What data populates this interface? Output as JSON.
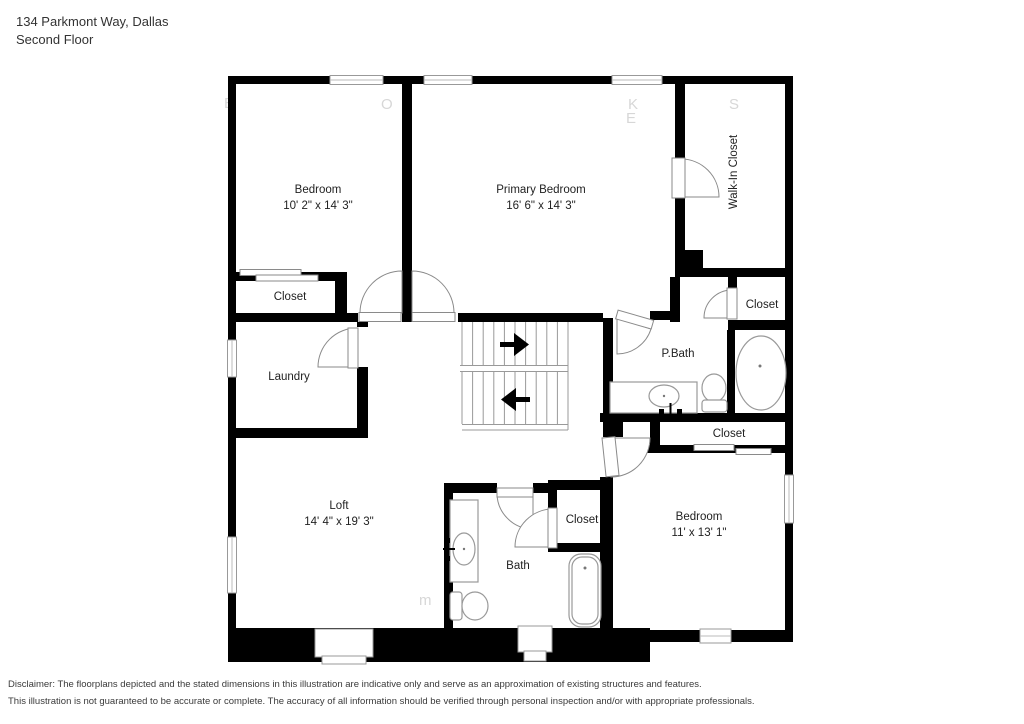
{
  "header": {
    "address": "134 Parkmont Way, Dallas",
    "floor": "Second Floor"
  },
  "rooms": {
    "bedroom1": {
      "name": "Bedroom",
      "dims": "10' 2\" x 14' 3\""
    },
    "primary": {
      "name": "Primary Bedroom",
      "dims": "16' 6\" x 14' 3\""
    },
    "walkin": {
      "name": "Walk-In Closet"
    },
    "closet_tl": {
      "name": "Closet"
    },
    "laundry": {
      "name": "Laundry"
    },
    "pbath": {
      "name": "P.Bath"
    },
    "closet_pb": {
      "name": "Closet"
    },
    "loft": {
      "name": "Loft",
      "dims": "14' 4\" x 19' 3\""
    },
    "bath": {
      "name": "Bath"
    },
    "closet_bath": {
      "name": "Closet"
    },
    "closet_b2": {
      "name": "Closet"
    },
    "bedroom2": {
      "name": "Bedroom",
      "dims": "11' x 13' 1\""
    }
  },
  "watermark": {
    "letters": [
      "E",
      "O",
      "K",
      "E",
      "S",
      "m"
    ]
  },
  "disclaimer": {
    "line1": "Disclaimer: The floorplans depicted and the stated dimensions in this illustration are indicative only and serve as an approximation of existing structures and features.",
    "line2": "This illustration is not guaranteed to be accurate or complete. The accuracy of all information should be verified through personal inspection and/or with appropriate professionals."
  }
}
